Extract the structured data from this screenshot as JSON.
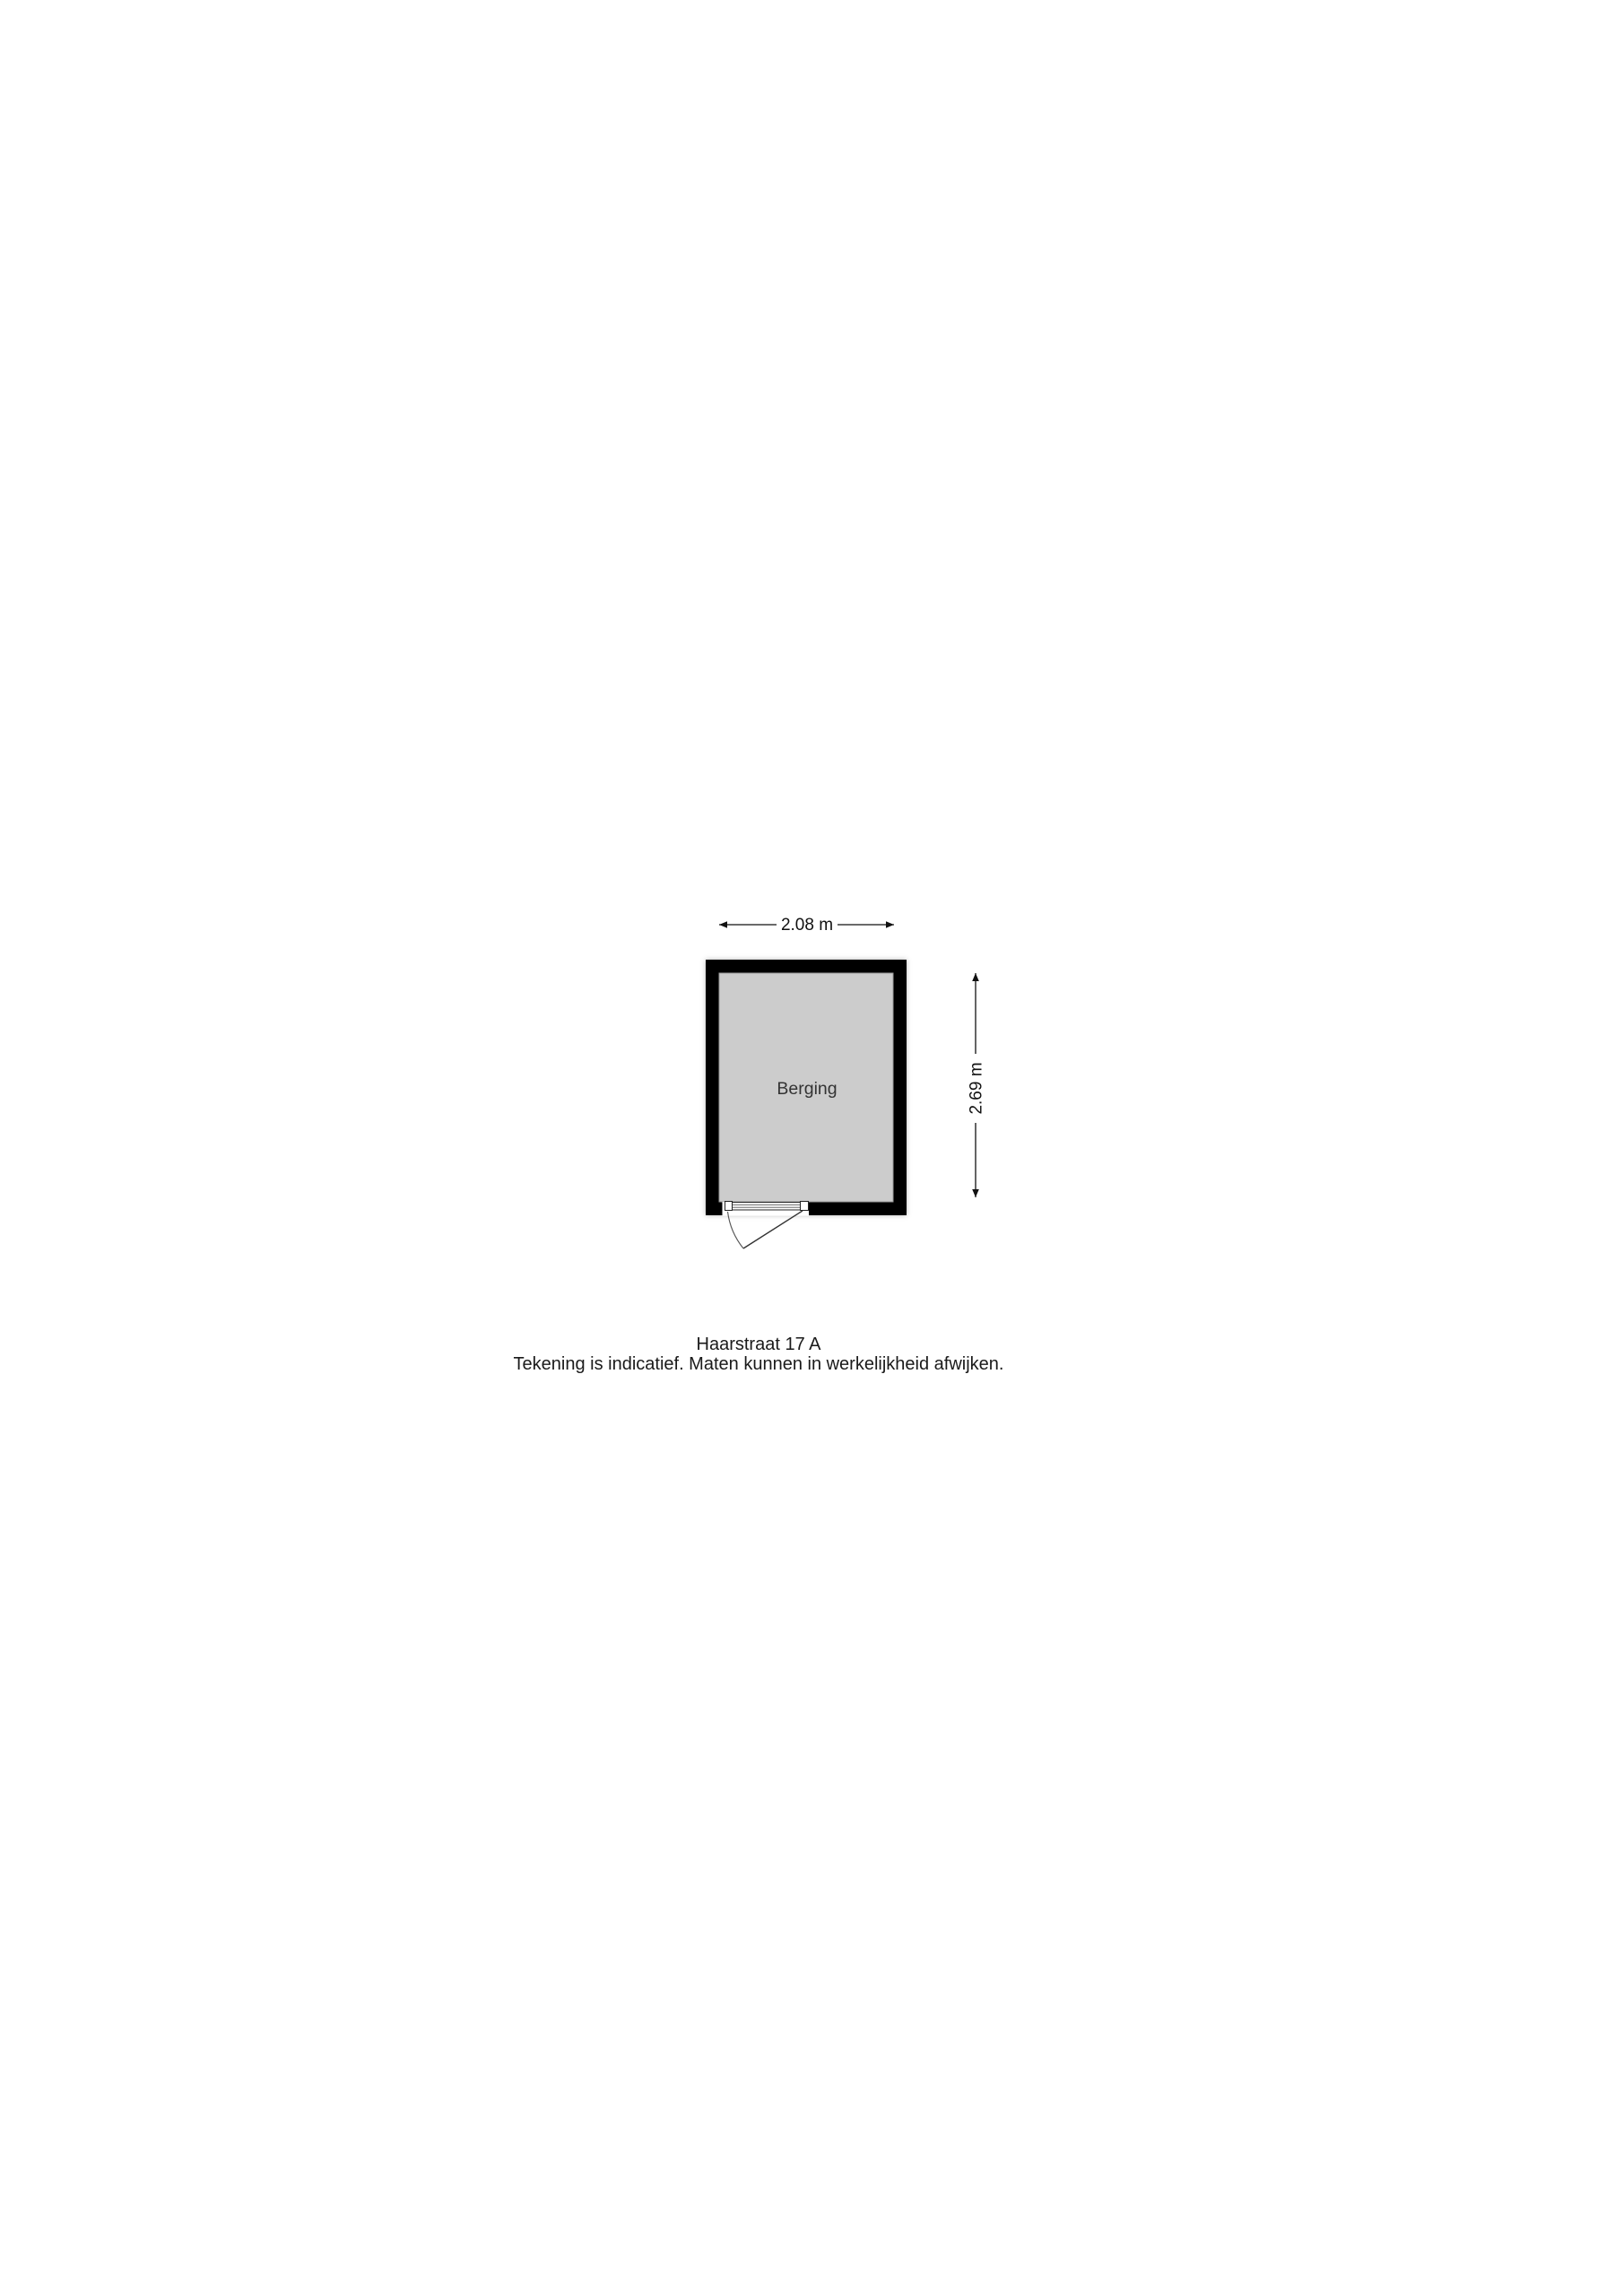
{
  "floorplan": {
    "room_label": "Berging",
    "width_dimension": "2.08 m",
    "height_dimension": "2.69 m"
  },
  "caption": {
    "address": "Haarstraat 17 A",
    "disclaimer": "Tekening is indicatief. Maten kunnen in werkelijkheid afwijken."
  },
  "colors": {
    "wall": "#000000",
    "floor": "#cccccc",
    "floor_border": "#9a9a9a",
    "label_text": "#333333"
  }
}
